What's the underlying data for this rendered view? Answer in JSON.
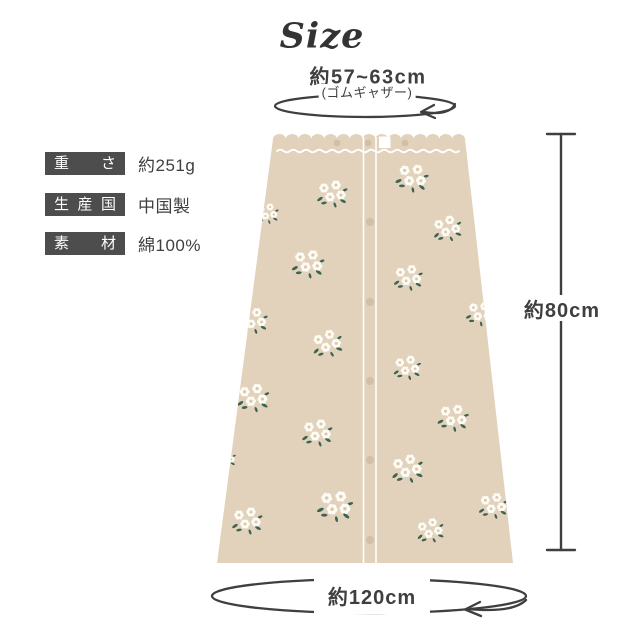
{
  "title": "Size",
  "waist": {
    "value": "約57~63cm",
    "note": "(ゴムギャザー)"
  },
  "length": {
    "value": "約80cm"
  },
  "hem": {
    "value": "約120cm"
  },
  "specs": [
    {
      "label": "重さ",
      "value": "約251g"
    },
    {
      "label": "生産国",
      "value": "中国製"
    },
    {
      "label": "素材",
      "value": "綿100%"
    }
  ],
  "colors": {
    "fabric": "#e2d2bb",
    "button": "#d2bfa4",
    "leaf": "#3d6353",
    "petal": "#fcfbf5",
    "flower_center": "#dbc8a3",
    "line": "#3f3f3f",
    "label_box": "#4d4d4d",
    "title_text": "#333333"
  }
}
